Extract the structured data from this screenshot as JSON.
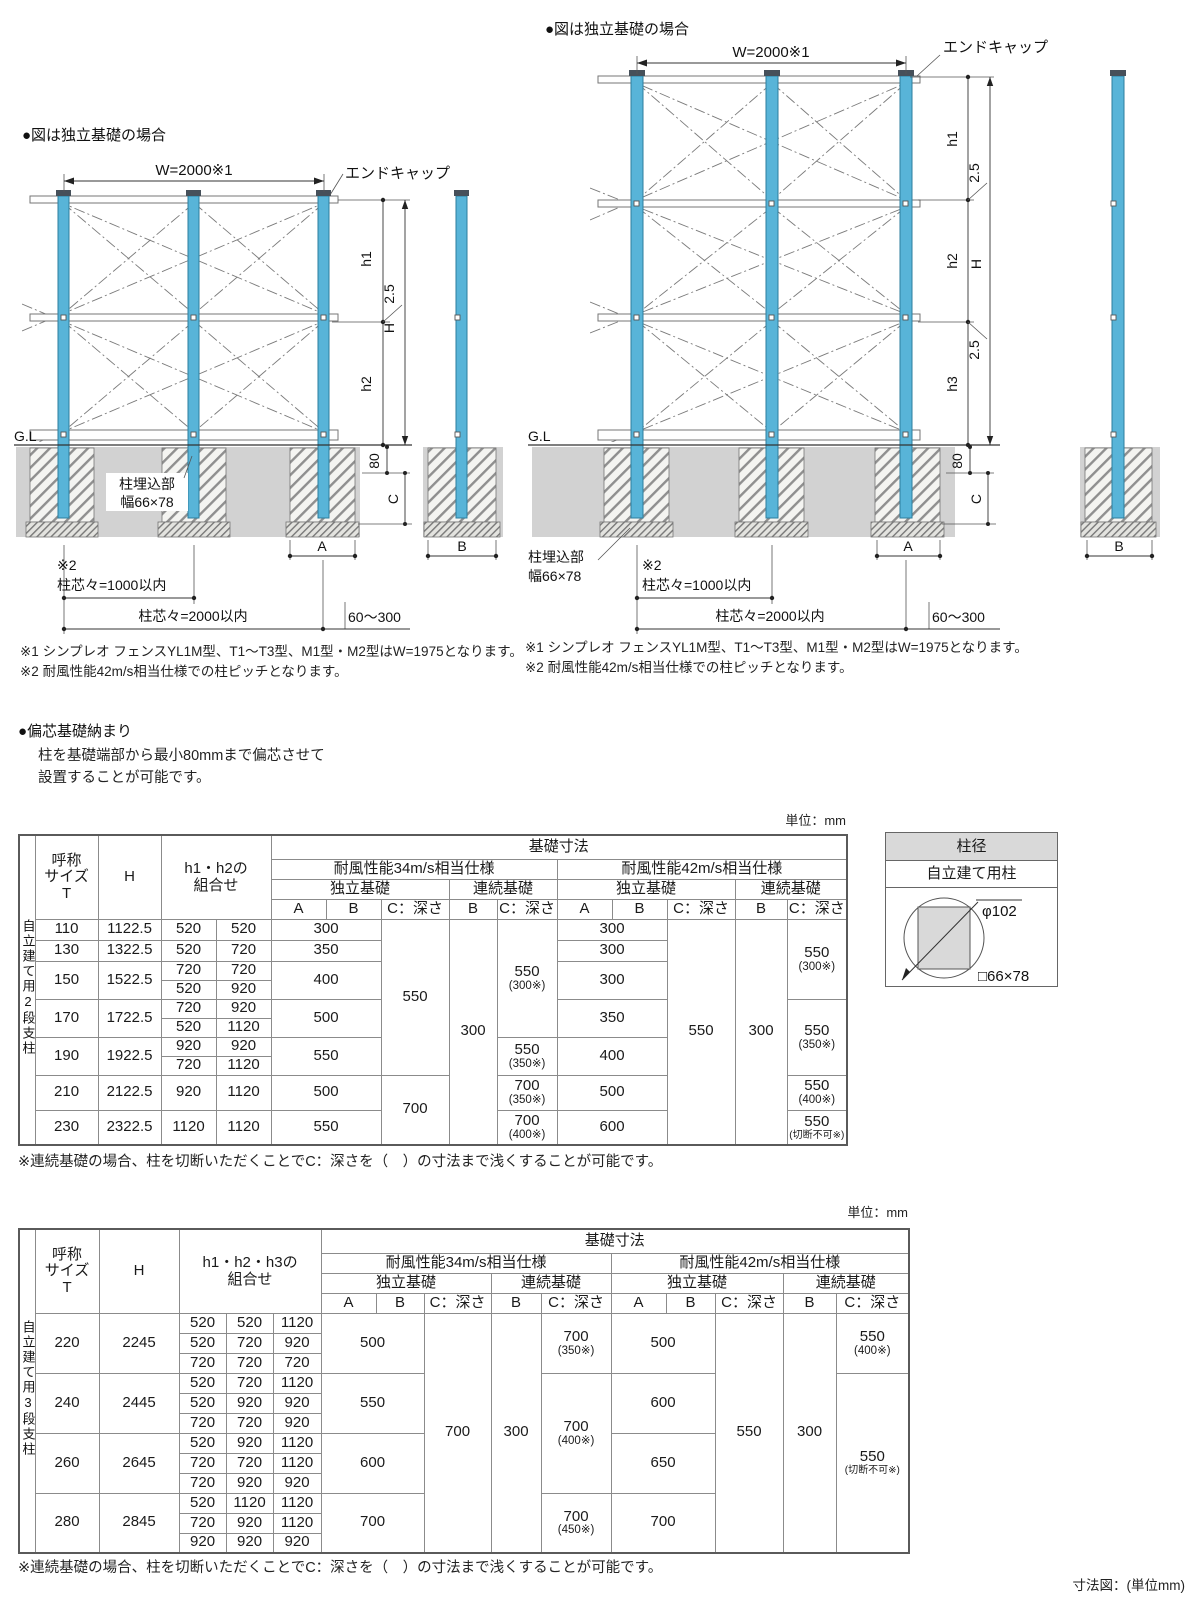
{
  "dl": {
    "title": "●図は独立基礎の場合",
    "w": "W=2000※1",
    "endcap": "エンドキャップ",
    "h1": "h1",
    "h2": "h2",
    "H": "H",
    "r25": "2.5",
    "gl": "G.L",
    "d80": "80",
    "c": "C",
    "emb1": "柱埋込部",
    "emb2": "幅66×78",
    "m2": "※2",
    "p1000": "柱芯々=1000以内",
    "p2000": "柱芯々=2000以内",
    "r60": "60～300",
    "a": "A",
    "b": "B",
    "note1": "※1 シンプレオ フェンスYL1M型、T1～T3型、M1型・M2型はW=1975となります。",
    "note2": "※2 耐風性能42m/s相当仕様での柱ピッチとなります。"
  },
  "dr": {
    "title": "●図は独立基礎の場合",
    "w": "W=2000※1",
    "endcap": "エンドキャップ",
    "h1": "h1",
    "h2": "h2",
    "h3": "h3",
    "H": "H",
    "r25": "2.5",
    "r25b": "2.5",
    "gl": "G.L",
    "d80": "80",
    "c": "C",
    "emb1": "柱埋込部",
    "emb2": "幅66×78",
    "m2": "※2",
    "p1000": "柱芯々=1000以内",
    "p2000": "柱芯々=2000以内",
    "r60": "60～300",
    "a": "A",
    "b": "B",
    "note1": "※1 シンプレオ フェンスYL1M型、T1～T3型、M1型・M2型はW=1975となります。",
    "note2": "※2 耐風性能42m/s相当仕様での柱ピッチとなります。"
  },
  "ecc": {
    "title": "●偏芯基礎納まり",
    "l1": "柱を基礎端部から最小80mmまで偏芯させて",
    "l2": "設置することが可能です。"
  },
  "t1": {
    "unit": "単位：mm",
    "group": "自立建て用2段支柱",
    "hdr": {
      "size1": "呼称",
      "size2": "サイズ",
      "size3": "T",
      "h": "H",
      "combo1": "h1・h2の",
      "combo2": "組合せ",
      "base": "基礎寸法",
      "w34": "耐風性能34m/s相当仕様",
      "w42": "耐風性能42m/s相当仕様",
      "indep": "独立基礎",
      "cont": "連続基礎",
      "a": "A",
      "b": "B",
      "c": "C：深さ"
    },
    "rows": [
      {
        "t": "110",
        "h": "1122.5",
        "c1": "520",
        "c2": "520",
        "a34": "300",
        "c34i": "550",
        "b34c": "300",
        "c34c": {
          "v": "550",
          "s": "(300※)"
        },
        "a42": "300",
        "c42i": "550",
        "b42c": "300",
        "c42c": {
          "v": "550",
          "s": "(300※)"
        }
      },
      {
        "t": "130",
        "h": "1322.5",
        "c1": "520",
        "c2": "720",
        "a34": "350",
        "a42": "300"
      },
      {
        "t": "150",
        "h": "1522.5",
        "c1": "720",
        "c2": "720",
        "a34": "400",
        "a42": "300"
      },
      {
        "c1": "520",
        "c2": "920"
      },
      {
        "t": "170",
        "h": "1722.5",
        "c1": "720",
        "c2": "920",
        "a34": "500",
        "a42": "350",
        "c42c": {
          "v": "550",
          "s": "(350※)"
        }
      },
      {
        "c1": "520",
        "c2": "1120"
      },
      {
        "t": "190",
        "h": "1922.5",
        "c1": "920",
        "c2": "920",
        "a34": "550",
        "c34c": {
          "v": "550",
          "s": "(350※)"
        },
        "a42": "400"
      },
      {
        "c1": "720",
        "c2": "1120"
      },
      {
        "t": "210",
        "h": "2122.5",
        "c1": "920",
        "c2": "1120",
        "a34": "500",
        "c34i": "700",
        "c34c": {
          "v": "700",
          "s": "(350※)"
        },
        "a42": "500",
        "c42c": {
          "v": "550",
          "s": "(400※)"
        }
      },
      {
        "t": "230",
        "h": "2322.5",
        "c1": "1120",
        "c2": "1120",
        "a34": "550",
        "c34c": {
          "v": "700",
          "s": "(400※)"
        },
        "a42": "600",
        "c42c": {
          "v": "550",
          "s": "(切断不可※)"
        }
      }
    ],
    "note": "※連続基礎の場合、柱を切断いただくことでC：深さを（　）の寸法まで浅くすることが可能です。"
  },
  "pb": {
    "title": "柱径",
    "sub": "自立建て用柱",
    "dia": "φ102",
    "sq": "□66×78"
  },
  "t2": {
    "unit": "単位：mm",
    "group": "自立建て用3段支柱",
    "hdr": {
      "size1": "呼称",
      "size2": "サイズ",
      "size3": "T",
      "h": "H",
      "combo1": "h1・h2・h3の",
      "combo2": "組合せ",
      "base": "基礎寸法",
      "w34": "耐風性能34m/s相当仕様",
      "w42": "耐風性能42m/s相当仕様",
      "indep": "独立基礎",
      "cont": "連続基礎",
      "a": "A",
      "b": "B",
      "c": "C：深さ"
    },
    "rows": [
      {
        "t": "220",
        "h": "2245",
        "c1": "520",
        "c2": "520",
        "c3": "1120",
        "a34": "500",
        "c34i": "700",
        "b34c": "300",
        "c34c": {
          "v": "700",
          "s": "(350※)"
        },
        "a42": "500",
        "c42i": "550",
        "b42c": "300",
        "c42c": {
          "v": "550",
          "s": "(400※)"
        }
      },
      {
        "c1": "520",
        "c2": "720",
        "c3": "920"
      },
      {
        "c1": "720",
        "c2": "720",
        "c3": "720"
      },
      {
        "t": "240",
        "h": "2445",
        "c1": "520",
        "c2": "720",
        "c3": "1120",
        "a34": "550",
        "c34c": {
          "v": "700",
          "s": "(400※)"
        },
        "a42": "600",
        "c42c": {
          "v": "550",
          "s": "(切断不可※)"
        }
      },
      {
        "c1": "520",
        "c2": "920",
        "c3": "920"
      },
      {
        "c1": "720",
        "c2": "720",
        "c3": "920"
      },
      {
        "t": "260",
        "h": "2645",
        "c1": "520",
        "c2": "920",
        "c3": "1120",
        "a34": "600",
        "a42": "650"
      },
      {
        "c1": "720",
        "c2": "720",
        "c3": "1120"
      },
      {
        "c1": "720",
        "c2": "920",
        "c3": "920"
      },
      {
        "t": "280",
        "h": "2845",
        "c1": "520",
        "c2": "1120",
        "c3": "1120",
        "a34": "700",
        "c34c": {
          "v": "700",
          "s": "(450※)"
        },
        "a42": "700"
      },
      {
        "c1": "720",
        "c2": "920",
        "c3": "1120"
      },
      {
        "c1": "920",
        "c2": "920",
        "c3": "920"
      }
    ],
    "note": "※連続基礎の場合、柱を切断いただくことでC：深さを（　）の寸法まで浅くすることが可能です。"
  },
  "ft": {
    "dim_note": "寸法図：(単位mm)"
  }
}
